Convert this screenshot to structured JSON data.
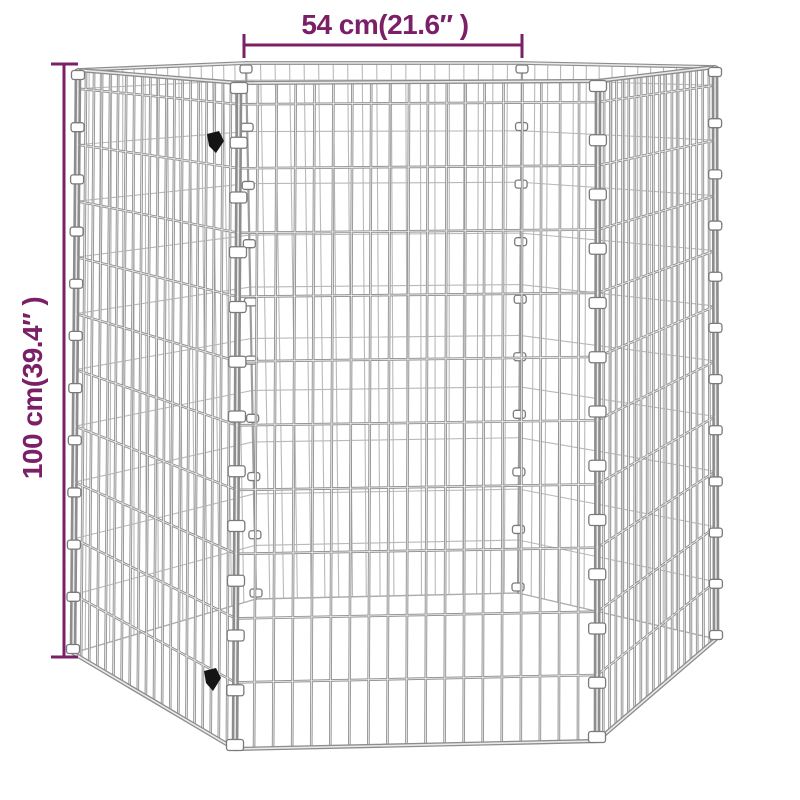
{
  "page": {
    "background": "#ffffff",
    "kind": "product dimension illustration"
  },
  "annotations": {
    "accent_color": "#7B2066",
    "width_label": "54 cm(21.6″ )",
    "height_label": "100 cm(39.4″ )"
  },
  "product": {
    "description": "6-panel hexagonal galvanized wire mesh pet playpen, open top, viewed from slightly above",
    "panel_width_cm": "54",
    "panel_height_cm": "100",
    "wire_color": "#8d8d8d",
    "wire_highlight_color": "#eaeaea",
    "back_wire_color": "#b9b9b9",
    "clip_color": "#ffffff",
    "clip_outline_color": "#7a7a7a",
    "latch_color": "#141414"
  }
}
